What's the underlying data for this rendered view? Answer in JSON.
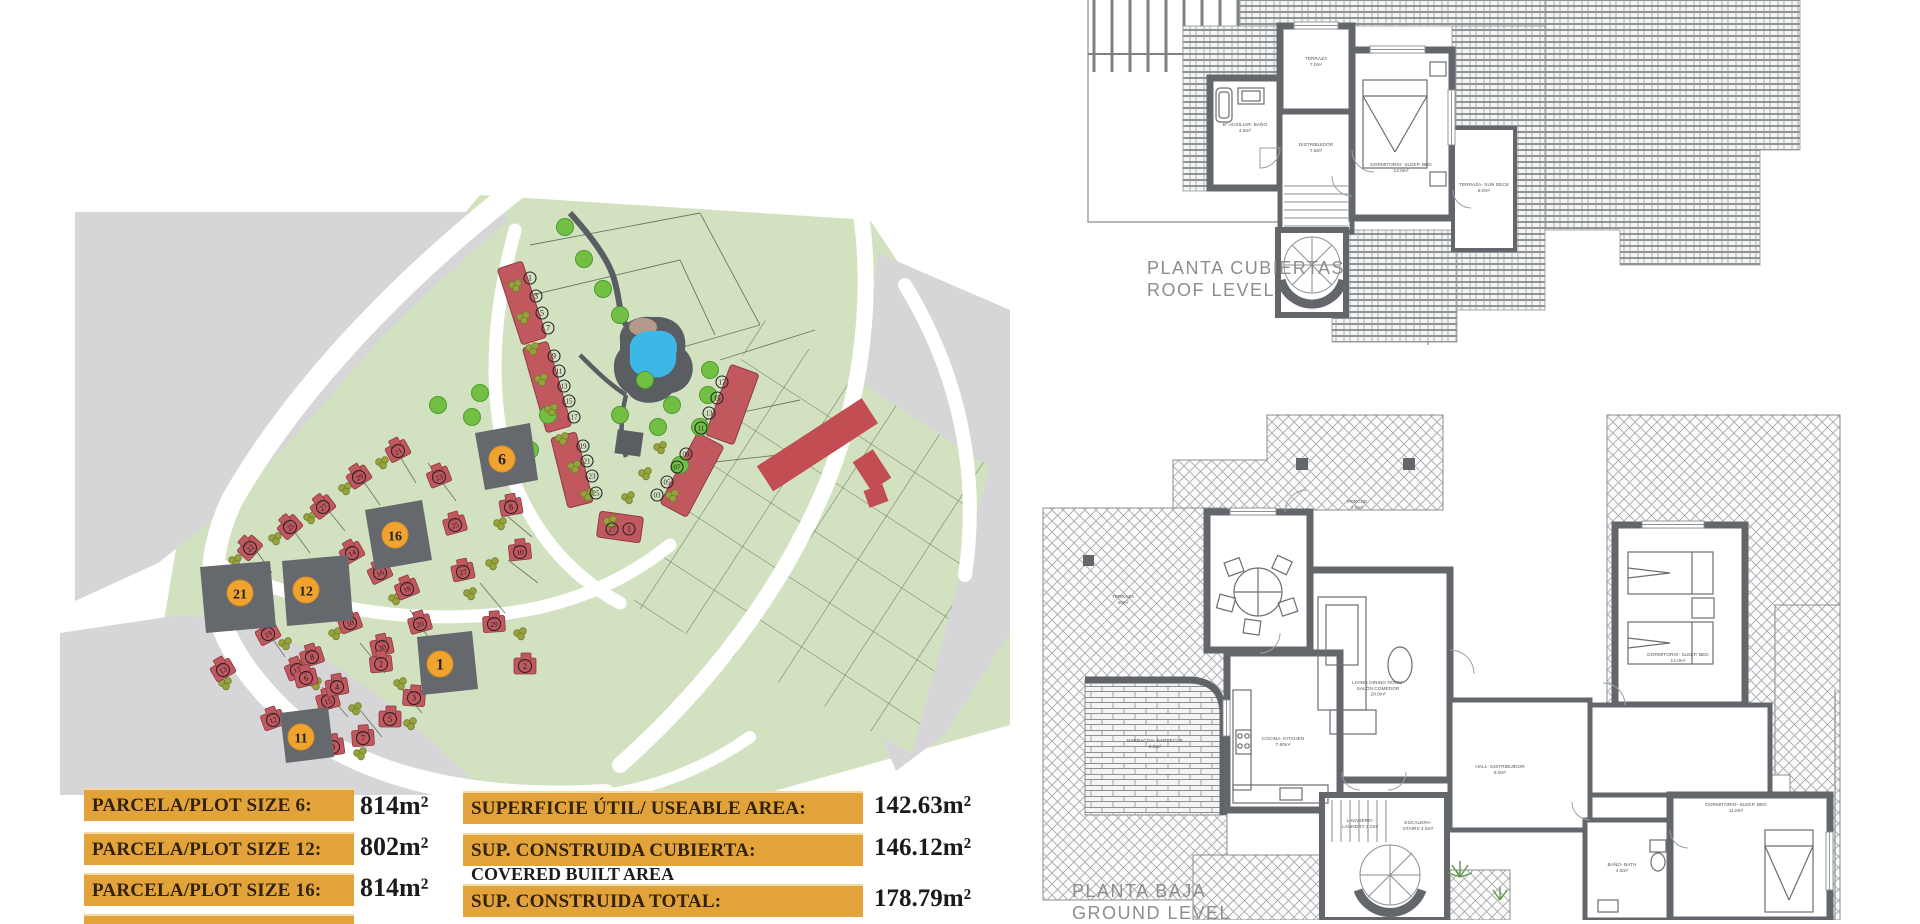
{
  "table": {
    "left": [
      {
        "label": "PARCELA/PLOT SIZE 6:",
        "value": "814m²"
      },
      {
        "label": "PARCELA/PLOT SIZE 12:",
        "value": "802m²"
      },
      {
        "label": "PARCELA/PLOT SIZE 16:",
        "value": "814m²"
      }
    ],
    "right": [
      {
        "label": "SUPERFICIE ÚTIL/ USEABLE AREA:",
        "value": "142.63m²",
        "sub": ""
      },
      {
        "label": "SUP. CONSTRUIDA CUBIERTA:",
        "value": "146.12m²",
        "sub": "COVERED BUILT AREA"
      },
      {
        "label": "SUP. CONSTRUIDA TOTAL:",
        "value": "178.79m²",
        "sub": ""
      }
    ]
  },
  "roof_plan": {
    "title_es": "PLANTA CUBIERTAS",
    "title_en": "ROOF LEVEL",
    "labels": [
      {
        "x": 256,
        "y": 60,
        "lines": [
          "TERRAZA",
          "7.0m²"
        ]
      },
      {
        "x": 185,
        "y": 126,
        "lines": [
          "Bº AUXILIAR- BAÑO",
          "4.5m²"
        ]
      },
      {
        "x": 256,
        "y": 146,
        "lines": [
          "DISTRIBUIDOR",
          "7.5m²"
        ]
      },
      {
        "x": 341,
        "y": 166,
        "lines": [
          "DORMITORIO- SLEEP. BED",
          "12.0m²"
        ]
      },
      {
        "x": 424,
        "y": 186,
        "lines": [
          "TERRAZA- SUN DECK",
          "8.0m²"
        ]
      }
    ]
  },
  "ground_plan": {
    "title_es": "PLANTA BAJA",
    "title_en": "GROUND LEVEL",
    "labels": [
      {
        "x": 327,
        "y": 103,
        "lines": [
          "PORCHE",
          "7.0m²"
        ]
      },
      {
        "x": 93,
        "y": 198,
        "lines": [
          "TERRAZA",
          "40m²"
        ]
      },
      {
        "x": 125,
        "y": 342,
        "lines": [
          "BARBACOA- BARBECUE",
          "6.0m²"
        ]
      },
      {
        "x": 253,
        "y": 340,
        "lines": [
          "COCINA- KITCHEN",
          "7.80m²"
        ]
      },
      {
        "x": 348,
        "y": 284,
        "lines": [
          "LIVING DINING ROOM-",
          "SALÓN COMEDOR",
          "28.0m²"
        ]
      },
      {
        "x": 470,
        "y": 368,
        "lines": [
          "HALL- DISTRIBUIDOR",
          "8.0m²"
        ]
      },
      {
        "x": 648,
        "y": 256,
        "lines": [
          "DORMITORIO- SLEEP. BED",
          "12.0m²"
        ]
      },
      {
        "x": 706,
        "y": 406,
        "lines": [
          "DORMITORIO- SLEEP. BED",
          "11.0m²"
        ]
      },
      {
        "x": 592,
        "y": 466,
        "lines": [
          "BAÑO- BATH",
          "4.5m²"
        ]
      },
      {
        "x": 330,
        "y": 422,
        "lines": [
          "LAVADERO-",
          "LAUNDRY 3.0m²"
        ]
      },
      {
        "x": 388,
        "y": 424,
        "lines": [
          "ESCALERA-",
          "STAIRS 4.5m²"
        ]
      }
    ]
  },
  "site_plan": {
    "markers": [
      {
        "n": "6",
        "x": 442,
        "y": 294,
        "plot": "415,268 470,258 478,315 425,325"
      },
      {
        "n": "16",
        "x": 335,
        "y": 370,
        "plot": "305,345 362,335 372,395 315,405"
      },
      {
        "n": "12",
        "x": 246,
        "y": 425,
        "plot": "222,396 288,390 293,455 227,461"
      },
      {
        "n": "21",
        "x": 180,
        "y": 428,
        "plot": "140,402 210,396 216,462 146,468"
      },
      {
        "n": "11",
        "x": 241,
        "y": 572,
        "plot": "220,548 268,542 274,592 226,598"
      },
      {
        "n": "1",
        "x": 380,
        "y": 499,
        "plot": "357,472 412,466 418,524 362,530"
      }
    ],
    "terrace_numbers_left": [
      {
        "n": "1",
        "x": 470,
        "y": 113
      },
      {
        "n": "3",
        "x": 476,
        "y": 131
      },
      {
        "n": "5",
        "x": 482,
        "y": 148
      },
      {
        "n": "7",
        "x": 488,
        "y": 163
      },
      {
        "n": "9",
        "x": 494,
        "y": 191
      },
      {
        "n": "11",
        "x": 499,
        "y": 206
      },
      {
        "n": "13",
        "x": 504,
        "y": 221
      },
      {
        "n": "15",
        "x": 509,
        "y": 236
      },
      {
        "n": "17",
        "x": 514,
        "y": 252
      },
      {
        "n": "19",
        "x": 523,
        "y": 281
      },
      {
        "n": "21",
        "x": 527,
        "y": 296
      },
      {
        "n": "23",
        "x": 532,
        "y": 311
      },
      {
        "n": "25",
        "x": 536,
        "y": 328
      },
      {
        "n": "27",
        "x": 552,
        "y": 364
      },
      {
        "n": "1",
        "x": 569,
        "y": 364
      }
    ],
    "terrace_numbers_right": [
      {
        "n": "17",
        "x": 662,
        "y": 217
      },
      {
        "n": "15",
        "x": 657,
        "y": 233
      },
      {
        "n": "13",
        "x": 649,
        "y": 248
      },
      {
        "n": "11",
        "x": 641,
        "y": 263
      },
      {
        "n": "09",
        "x": 626,
        "y": 289
      },
      {
        "n": "07",
        "x": 617,
        "y": 302
      },
      {
        "n": "05",
        "x": 607,
        "y": 317
      },
      {
        "n": "03",
        "x": 597,
        "y": 330
      }
    ],
    "fan_houses": [
      {
        "n": "22",
        "x": 190,
        "y": 383,
        "rot": -48
      },
      {
        "n": "25",
        "x": 230,
        "y": 362,
        "rot": -42
      },
      {
        "n": "27",
        "x": 263,
        "y": 342,
        "rot": -38
      },
      {
        "n": "29",
        "x": 299,
        "y": 312,
        "rot": -34
      },
      {
        "n": "21",
        "x": 338,
        "y": 286,
        "rot": -28
      },
      {
        "n": "23",
        "x": 379,
        "y": 312,
        "rot": -22
      },
      {
        "n": "14",
        "x": 292,
        "y": 388,
        "rot": -30
      },
      {
        "n": "16",
        "x": 320,
        "y": 408,
        "rot": -26
      },
      {
        "n": "18",
        "x": 347,
        "y": 424,
        "rot": -22
      },
      {
        "n": "20",
        "x": 360,
        "y": 459,
        "rot": -16
      },
      {
        "n": "10",
        "x": 290,
        "y": 458,
        "rot": -20
      },
      {
        "n": "30",
        "x": 322,
        "y": 482,
        "rot": -12
      },
      {
        "n": "25",
        "x": 395,
        "y": 360,
        "rot": -16
      },
      {
        "n": "27",
        "x": 403,
        "y": 407,
        "rot": -12
      },
      {
        "n": "8",
        "x": 451,
        "y": 342,
        "rot": -10
      },
      {
        "n": "10",
        "x": 460,
        "y": 387,
        "rot": -6
      },
      {
        "n": "29",
        "x": 434,
        "y": 459,
        "rot": -4
      },
      {
        "n": "2",
        "x": 465,
        "y": 501,
        "rot": 0
      },
      {
        "n": "19",
        "x": 208,
        "y": 469,
        "rot": -28
      },
      {
        "n": "17",
        "x": 237,
        "y": 505,
        "rot": -22
      },
      {
        "n": "15",
        "x": 268,
        "y": 536,
        "rot": -16
      },
      {
        "n": "13",
        "x": 163,
        "y": 505,
        "rot": -30
      },
      {
        "n": "12",
        "x": 213,
        "y": 555,
        "rot": -20
      },
      {
        "n": "8",
        "x": 252,
        "y": 492,
        "rot": -18
      },
      {
        "n": "6",
        "x": 246,
        "y": 513,
        "rot": -14
      },
      {
        "n": "4",
        "x": 277,
        "y": 522,
        "rot": -10
      },
      {
        "n": "2",
        "x": 321,
        "y": 499,
        "rot": -6
      },
      {
        "n": "9",
        "x": 273,
        "y": 582,
        "rot": -8
      },
      {
        "n": "7",
        "x": 303,
        "y": 573,
        "rot": -4
      },
      {
        "n": "5",
        "x": 330,
        "y": 554,
        "rot": 0
      },
      {
        "n": "3",
        "x": 354,
        "y": 533,
        "rot": 4
      }
    ],
    "trees_round": [
      [
        505,
        62
      ],
      [
        524,
        94
      ],
      [
        543,
        124
      ],
      [
        560,
        150
      ],
      [
        585,
        215
      ],
      [
        612,
        240
      ],
      [
        640,
        262
      ],
      [
        598,
        262
      ],
      [
        488,
        250
      ],
      [
        470,
        285
      ],
      [
        620,
        300
      ],
      [
        648,
        230
      ],
      [
        378,
        240
      ],
      [
        420,
        228
      ],
      [
        412,
        252
      ],
      [
        650,
        205
      ],
      [
        560,
        250
      ]
    ],
    "trees_olive": [
      [
        455,
        120
      ],
      [
        463,
        152
      ],
      [
        472,
        183
      ],
      [
        481,
        214
      ],
      [
        491,
        244
      ],
      [
        502,
        273
      ],
      [
        514,
        301
      ],
      [
        527,
        329
      ],
      [
        600,
        282
      ],
      [
        585,
        308
      ],
      [
        568,
        332
      ],
      [
        550,
        356
      ],
      [
        175,
        395
      ],
      [
        215,
        373
      ],
      [
        250,
        352
      ],
      [
        285,
        323
      ],
      [
        322,
        297
      ],
      [
        278,
        400
      ],
      [
        335,
        433
      ],
      [
        275,
        468
      ],
      [
        225,
        478
      ],
      [
        255,
        518
      ],
      [
        295,
        543
      ],
      [
        340,
        518
      ],
      [
        370,
        488
      ],
      [
        410,
        428
      ],
      [
        440,
        358
      ],
      [
        432,
        398
      ],
      [
        460,
        468
      ],
      [
        198,
        450
      ],
      [
        165,
        518
      ],
      [
        300,
        588
      ],
      [
        350,
        558
      ],
      [
        390,
        518
      ],
      [
        612,
        330
      ]
    ],
    "colors": {
      "green": "#d2e2c0",
      "gray": "#d6d6d8",
      "house_red": "#c0585e",
      "house_red_dark": "#8e3a42",
      "club_red": "#c24d52",
      "dark_plot": "#65696d",
      "marker_orange": "#f0a42f",
      "pool_blue": "#3db6e8",
      "deck_gray": "#5a5e62",
      "tan": "#b49a8b",
      "tree_green": "#72bf44",
      "olive": "#97a23c",
      "wall": "#63676b"
    }
  }
}
